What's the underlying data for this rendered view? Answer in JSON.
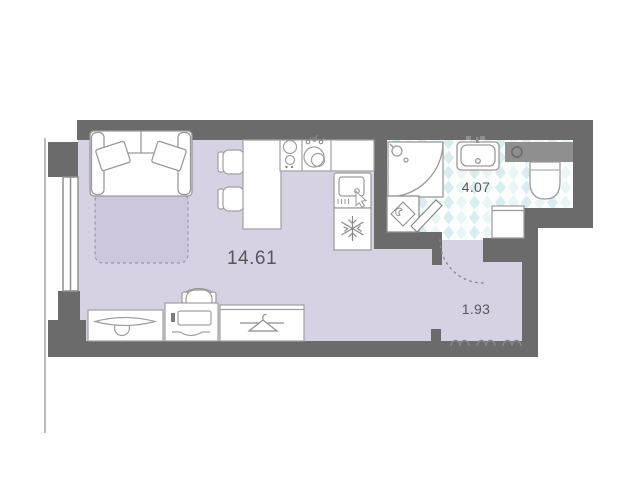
{
  "rooms": [
    {
      "name": "living-room-kitchen",
      "area_label": "14.61"
    },
    {
      "name": "bathroom",
      "area_label": "4.07"
    },
    {
      "name": "hallway",
      "area_label": "1.93"
    }
  ],
  "colors": {
    "wall": "#6b6b6b",
    "floor": "#d7d2e3",
    "bed_zone": "#cdc7db",
    "bed_zone_stroke": "#9b94ae",
    "tile_base": "#fcfefe",
    "tile_accent": "#d9edf1",
    "tile_accent_light": "#eaf5f6",
    "outline": "#9a9a9a",
    "label_text": "#57575c",
    "shelf": "#8f8f8f",
    "facade_line": "#bdbdbd",
    "furniture_fill": "#ffffff"
  },
  "icons": [
    "sofa-bed",
    "pull-out-bed-zone",
    "pillow",
    "dining-table",
    "dining-chair",
    "kitchen-hob",
    "kitchen-sink",
    "water-drops",
    "oven",
    "snowflake-refrigerator",
    "shower-cabin",
    "washbasin",
    "toilet",
    "washing-machine",
    "bathroom-cabinet",
    "door-leaf",
    "door-swing-arc",
    "window",
    "tv-stand",
    "desk",
    "desk-chair",
    "wardrobe",
    "clothes-hanger",
    "entrance-door-marks"
  ]
}
